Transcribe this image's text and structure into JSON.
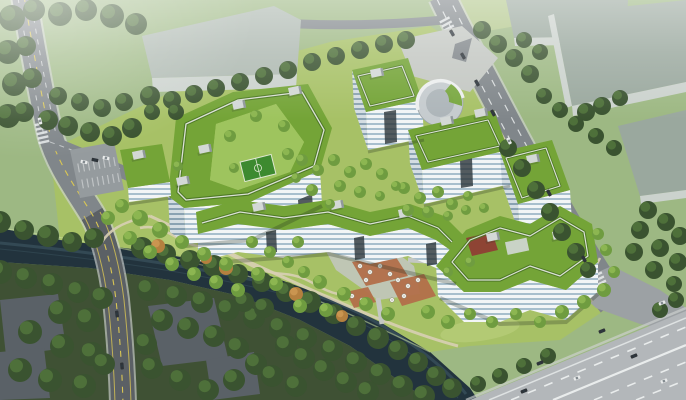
{
  "scene": {
    "type": "architectural-aerial-rendering",
    "subject": "riverside office campus of white mid-rise blocks with green roofs and rooftop running tracks",
    "landmarks": [
      "u-shaped northwest block with courtyard and mini soccer pitch",
      "serpentine south block with archways",
      "boomerang southeast block",
      "spiral drum pavilion at north tip",
      "central plaza with terracotta terraces and white umbrellas",
      "winding river with wooded banks",
      "gray warehouses along north and east edges",
      "dark industrial sheds in shadowed southwest corner",
      "multi-lane highway at southeast",
      "tree-lined arterial roads"
    ],
    "vehicle_counts": {
      "left_road": 3,
      "north_road": 7,
      "highway": 7,
      "parking_lot": 3
    },
    "lighting": "hazy daylight, bright center, shadowed lower-left corner"
  },
  "palette": {
    "grass_north": "#9db883",
    "grass_campus": "#a7c166",
    "woodland": "#3f5134",
    "water": "#22333d",
    "water_hi": "#44606c",
    "road": "#80868a",
    "road_dark": "#565c60",
    "highway": "#b3b7ba",
    "apron": "#9ca1a4",
    "curb": "#cfd3d1",
    "lane_white": "#e9ecec",
    "lane_yellow": "#d9c654",
    "warehouse_a": "#aeb9b1",
    "warehouse_b": "#9aa89e",
    "warehouse_front": "#cbd2cd",
    "shed": "#5a6167",
    "field": "#b5c98c",
    "plaza": "#c3c7c2",
    "path_tan": "#d8cfb4",
    "patio": "#b26f4a",
    "roof": "#74a437",
    "roof_dark": "#5d8c2b",
    "track_casing": "#4a7423",
    "track_line": "#e3e7df",
    "stripe_light": "#f2f5f6",
    "stripe_glass": "#a8bfcd",
    "stripe_light_sh": "#d4dde2",
    "stripe_glass_sh": "#8aa2b2",
    "arch": "#2b343a",
    "pavilion": "#8e4434",
    "lawn_court": "#9ec45e",
    "field_green": "#3d8a2f",
    "box_top": "#d3d8d6",
    "box_side": "#8f979a",
    "tree_dark": "#3a5330",
    "tree_dark_hi": "#567a3e",
    "tree_light": "#6f9c40",
    "tree_light_hi": "#94bd55",
    "tree_autumn": "#b4803f",
    "car_dark": "#2e3338",
    "car_white": "#e8eaea"
  }
}
